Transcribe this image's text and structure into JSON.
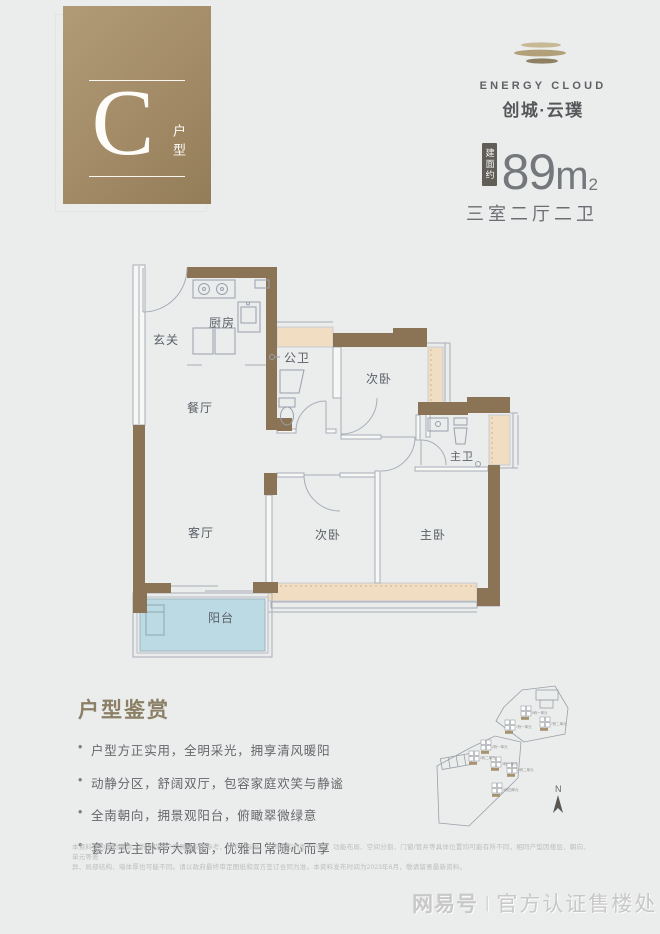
{
  "unit_badge": {
    "letter": "C",
    "label_vertical": "户型"
  },
  "brand": {
    "name_en": "ENERGY CLOUD",
    "name_cn": "创城·云璞"
  },
  "area": {
    "prefix_vertical": "建面约",
    "value": "89",
    "unit": "m",
    "sup": "2",
    "layout": "三室二厅二卫"
  },
  "floorplan": {
    "rooms": {
      "entry": "玄关",
      "kitchen": "厨房",
      "guest_bath": "公卫",
      "bedroom2": "次卧",
      "dining": "餐厅",
      "master_bath": "主卫",
      "living": "客厅",
      "bedroom3": "次卧",
      "master_bedroom": "主卧",
      "balcony": "阳台"
    }
  },
  "highlights": {
    "title": "户型鉴赏",
    "items": [
      "户型方正实用，全明采光，拥享清风暖阳",
      "动静分区，舒阔双厅，包容家庭欢笑与静谧",
      "全南朝向，拥景观阳台，俯瞰翠微绿意",
      "套房式主卧带大飘窗，优雅日常随心而享"
    ]
  },
  "siteplan": {
    "north_label": "N",
    "buildings": [
      "5栋一单元",
      "7栋一单元",
      "7栋二单元",
      "2栋一单元",
      "2栋二单元",
      "3栋一单元",
      "3栋二单元",
      "3栋四单元"
    ]
  },
  "disclaimer": {
    "line1": "本资料仅为要约邀请，所涉及的户型展示仅供参考，非交付标准。不同户型的面积尺寸、功能布局、空间分割、门窗/管井等具体位置均可能有所不同，相同户型因楼层、朝向、单元等差",
    "line2": "异、局部结构、墙体厚也可能不同。请以政府最终审定图纸和双方签订合同为准。本资料发布时间为2023年6月，敬请留意最新资料。"
  },
  "watermark": {
    "brand": "网易号",
    "divider": "|",
    "label": "官方认证售楼处"
  },
  "colors": {
    "wall": "#8b7356",
    "bay_window": "#f0ddc2",
    "balcony": "#bcdae4",
    "badge": "#a58d68",
    "accent_text": "#8b8066"
  }
}
